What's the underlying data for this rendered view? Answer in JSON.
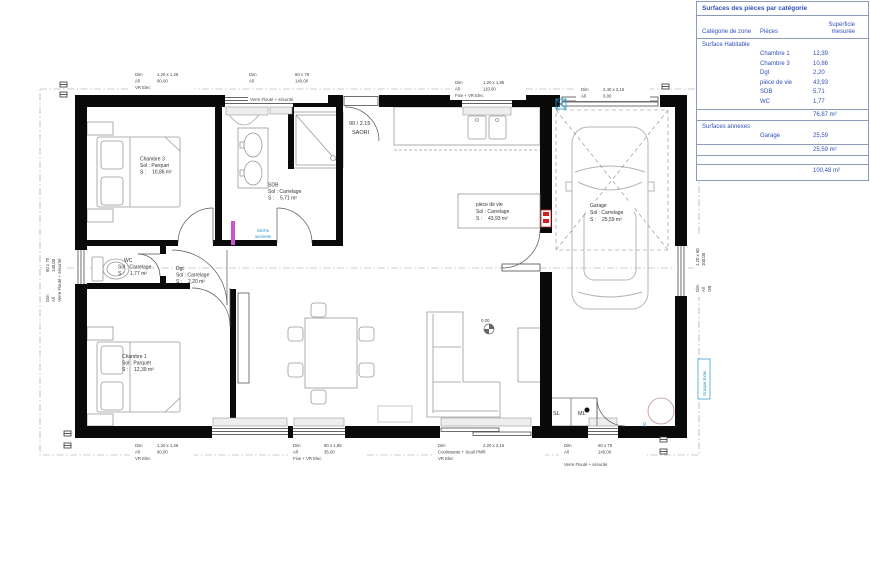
{
  "surface_table": {
    "title": "Surfaces des pièces par catégorie",
    "headers": {
      "zone": "Catégorie de zone",
      "pieces": "Pièces",
      "superficie_1": "Superficie",
      "superficie_2": "mesurée"
    },
    "section_habitable": "Surface Habitable",
    "habitable_rows": [
      {
        "piece": "Chambre 1",
        "value": "12,39"
      },
      {
        "piece": "Chambre 3",
        "value": "10,86"
      },
      {
        "piece": "Dgt",
        "value": "2,20"
      },
      {
        "piece": "pièce de vie",
        "value": "43,93"
      },
      {
        "piece": "SDB",
        "value": "5,71"
      },
      {
        "piece": "WC",
        "value": "1,77"
      }
    ],
    "habitable_total": "76,87 m²",
    "section_annexes": "Surfaces annexes",
    "annexes_rows": [
      {
        "piece": "Garage",
        "value": "25,59"
      }
    ],
    "annexes_total": "25,59 m²",
    "grand_total": "100,48 m²"
  },
  "rooms": {
    "chambre3": {
      "name": "Chambre 3",
      "floor": "Sol : Parquet",
      "area_label": "S :",
      "area_value": "10,86 m²"
    },
    "chambre1": {
      "name": "Chambre 1",
      "floor": "Sol : Parquet",
      "area_label": "S :",
      "area_value": "12,39 m²"
    },
    "sdb": {
      "name": "SDB",
      "floor": "Sol : Carrelage",
      "area_label": "S :",
      "area_value": "5,71 m²"
    },
    "wc": {
      "name": "WC",
      "floor": "Sol : Carrelage",
      "area_label": "S :",
      "area_value": "1,77 m²"
    },
    "dgt": {
      "name": "Dgt",
      "floor": "Sol : Carrelage",
      "area_label": "S :",
      "area_value": "2,20 m²"
    },
    "piece_de_vie": {
      "name": "pièce de vie",
      "floor": "Sol : Carrelage",
      "area_label": "S :",
      "area_value": "43,93 m²"
    },
    "garage": {
      "name": "Garage",
      "floor": "Sol : Carrelage",
      "area_label": "S :",
      "area_value": "25,59 m²"
    }
  },
  "entry_door": {
    "size": "90 / 2.15",
    "brand": "SAORI"
  },
  "labels": {
    "sl": "SL",
    "ml": "ML",
    "level": "0,00",
    "seche_1": "Sèche",
    "seche_2": "serviette",
    "groupe_ext": "Groupe Exter",
    "num_20": "20"
  },
  "win": {
    "t1": {
      "dim": "Dim",
      "dim_v": "1,20 x 1,25",
      "all": "All",
      "all_v": "90,00",
      "note": "VR Elec"
    },
    "t2": {
      "dim": "Dim",
      "dim_v": "60 x 75",
      "all": "All",
      "all_v": "140,00",
      "note": "Verre Flouté + sécurité"
    },
    "t3": {
      "dim": "Dim",
      "dim_v": "1,20 x 1,85",
      "all": "All",
      "all_v": "110,00",
      "note": "Fixe + VR Elec"
    },
    "t4": {
      "dim": "Dim",
      "dim_v": "2,40 x 2,15",
      "all": "All",
      "all_v": "0,00"
    },
    "b1": {
      "dim": "Dim",
      "dim_v": "1,20 x 1,25",
      "all": "All",
      "all_v": "90,00",
      "note": "VR Elec"
    },
    "b2": {
      "dim": "Dim",
      "dim_v": "90 x 1,85",
      "all": "All",
      "all_v": "35,00",
      "note": "Fixe + VR Elec"
    },
    "b3": {
      "dim": "Dim",
      "dim_v": "2,20 x 2,15",
      "note": "Coulissante + Seuil PMR",
      "note2": "VR Elec"
    },
    "b4": {
      "dim": "Dim",
      "dim_v": "60 x 75",
      "all": "All",
      "all_v": "140,00",
      "note": "Verre Flouté + sécurité"
    },
    "l1": {
      "dim": "Dim",
      "dim_v": "60 x 75",
      "all": "All",
      "all_v": "140,00",
      "note": "Verre Flouté + sécurité"
    },
    "r1": {
      "dim": "Dim",
      "dim_v": "1,20 x 60",
      "all": "All",
      "all_v": "100,00",
      "note": "OB"
    }
  },
  "colors": {
    "accent_blue": "#2299cc",
    "table_blue": "#3050b8",
    "alert_red": "#cc2222",
    "radiator_magenta": "#cc55cc"
  }
}
